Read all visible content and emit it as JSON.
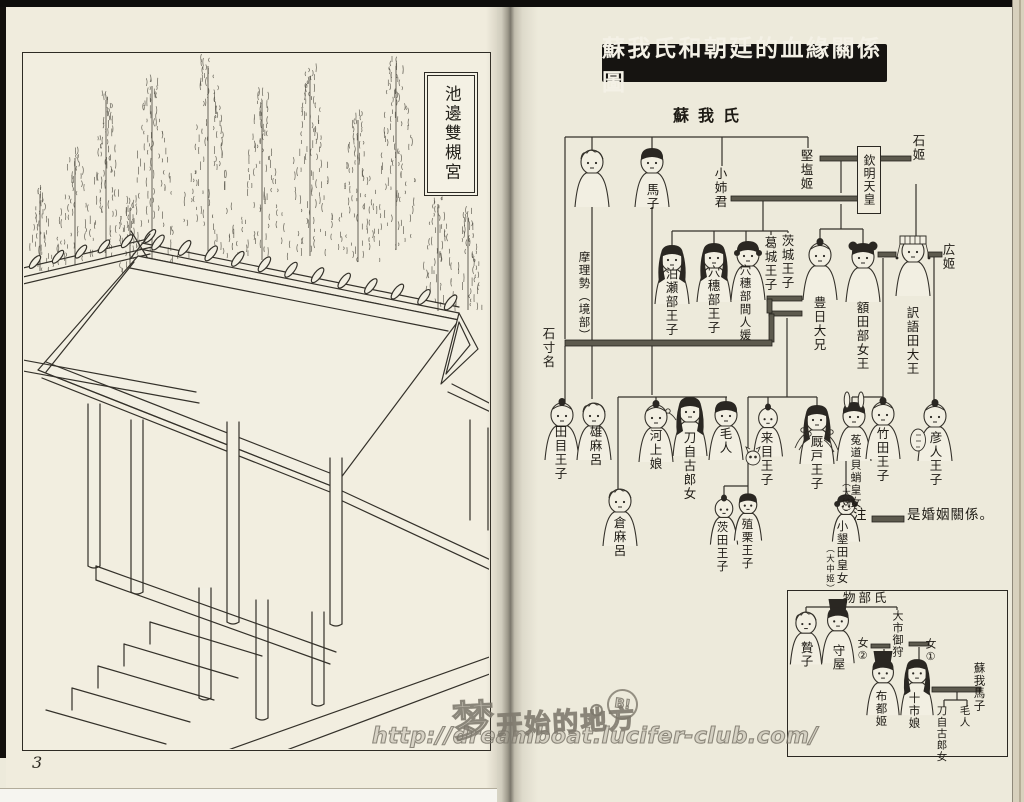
{
  "page": {
    "number": "3"
  },
  "left_page": {
    "caption": "池邊雙槻宮"
  },
  "watermark": {
    "site_name": "梦开始的地方",
    "dot": "○",
    "badge": "B!",
    "url": "http://dreamboat.lucifer-club.com/"
  },
  "diagram": {
    "title": "蘇我氏和朝廷的血緣關係圖",
    "clan_root": "蘇我氏",
    "emperor_box": "欽明天皇",
    "note_prefix": "注",
    "note_text": "是婚姻關係。",
    "nodes": {
      "ishikina": "石寸名",
      "marise": "摩理勢（境部）",
      "umako": "馬子",
      "koanekimi": "小姉君",
      "kitashihime": "堅塩姬",
      "ishihime": "石姬",
      "hirohime": "広姬",
      "hatsusebe": "泊瀬部王子",
      "anahobe": "穴穗部王子",
      "hashihito": "穴穗部間人媛",
      "katsuragi": "葛城王子",
      "ibaraki": "茨城王子",
      "toyohi": "豊日大兄",
      "nukatabe": "額田部女王",
      "osada": "訳語田大王",
      "tame": "田目王子",
      "omaro": "雄麻呂",
      "kuramaro": "倉麻呂",
      "kawakami": "河上娘",
      "tojiko": "刀自古郎女",
      "emishi": "毛人",
      "kume": "来目王子",
      "umayado": "厩戸王子",
      "uji": "菟道貝蛸皇女",
      "uji_note": "（大姊）",
      "takeda": "竹田王子",
      "hikohito": "彦人王子",
      "manda": "茨田王子",
      "ueguri": "殖栗王子",
      "oharida": "小墾田皇女",
      "oharida_note": "（大中姬）"
    },
    "inset": {
      "clan": "物部氏",
      "nodes": {
        "nieko": "贄子",
        "moriya": "守屋",
        "oichimikari": "大市御狩",
        "daughter2": "女②",
        "daughter1": "女①",
        "futohime": "布都姬",
        "toichi": "十市娘",
        "soga_umako": "蘇我馬子",
        "tojiko": "刀自古郎女",
        "emishi": "毛人"
      }
    }
  }
}
